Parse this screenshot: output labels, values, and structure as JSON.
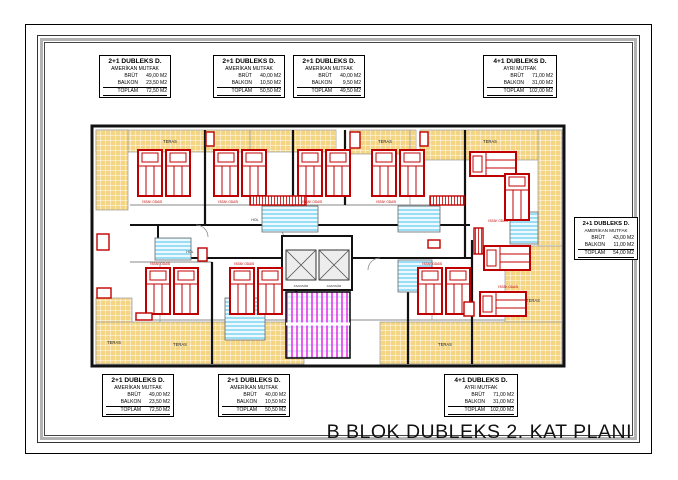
{
  "page": {
    "title": "B BLOK DUBLEKS 2. KAT PLANI"
  },
  "labels": {
    "brut": "BRÜT",
    "balkon": "BALKON",
    "toplam": "TOPLAM"
  },
  "info_boxes": [
    {
      "type": "2+1 DUBLEKS D.",
      "kitchen": "AMERİKAN MUTFAK",
      "brut": "49,00 M2",
      "balkon": "23,50 M2",
      "toplam": "72,50 M2"
    },
    {
      "type": "2+1 DUBLEKS D.",
      "kitchen": "AMERİKAN MUTFAK",
      "brut": "40,00 M2",
      "balkon": "10,50 M2",
      "toplam": "50,50 M2"
    },
    {
      "type": "2+1 DUBLEKS D.",
      "kitchen": "AMERİKAN MUTFAK",
      "brut": "40,00 M2",
      "balkon": "9,50 M2",
      "toplam": "49,50 M2"
    },
    {
      "type": "4+1 DUBLEKS D.",
      "kitchen": "AYRI MUTFAK",
      "brut": "71,00 M2",
      "balkon": "31,00 M2",
      "toplam": "102,00 M2"
    },
    {
      "type": "2+1 DUBLEKS D.",
      "kitchen": "AMERİKAN MUTFAK",
      "brut": "43,00 M2",
      "balkon": "11,00 M2",
      "toplam": "54,00 M2"
    },
    {
      "type": "2+1 DUBLEKS D.",
      "kitchen": "AMERİKAN MUTFAK",
      "brut": "49,00 M2",
      "balkon": "23,50 M2",
      "toplam": "72,50 M2"
    },
    {
      "type": "2+1 DUBLEKS D.",
      "kitchen": "AMERİKAN MUTFAK",
      "brut": "40,00 M2",
      "balkon": "10,50 M2",
      "toplam": "50,50 M2"
    },
    {
      "type": "4+1 DUBLEKS D.",
      "kitchen": "AYRI MUTFAK",
      "brut": "71,00 M2",
      "balkon": "31,00 M2",
      "toplam": "102,00 M2"
    }
  ],
  "plan": {
    "labels": {
      "teras": "TERAS",
      "yatak_odasi": "YATAK ODASI",
      "hol": "HOL",
      "asansor": "ASANSÖR"
    },
    "watermark": "BestProperty"
  },
  "colors": {
    "wall": "#111111",
    "furniture_red": "#c00000",
    "terrace_yellow": "#f3d584",
    "stair_cyan": "#55c8f0",
    "stair_magenta": "#ee3cee"
  }
}
